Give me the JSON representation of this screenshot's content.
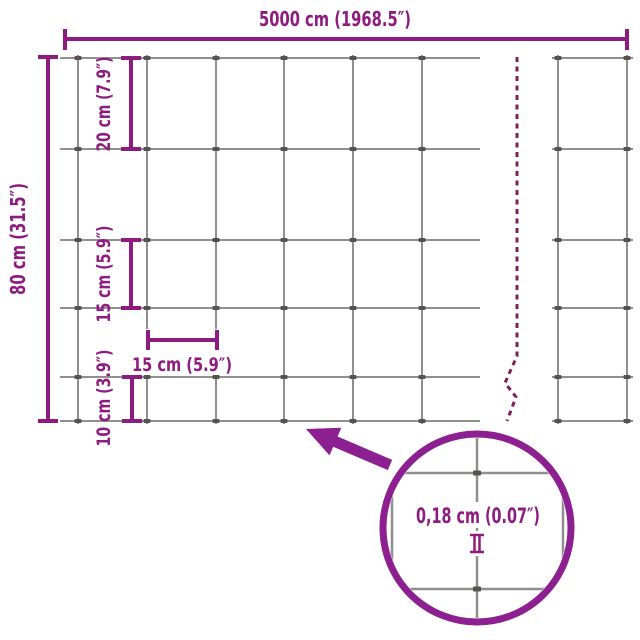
{
  "diagram": {
    "type": "fence-mesh-dimension-diagram",
    "colors": {
      "accent": "#8E1C80",
      "detail_accent": "#8D2090",
      "wire": "#8F8F8F",
      "clip": "#56524C",
      "break_line": "#7E2056",
      "background": "#FFFFFF"
    },
    "dimensions": {
      "total_width_label": "5000 cm (1968.5″)",
      "total_height_label": "80 cm (31.5″)",
      "row_gap_top_label": "20 cm (7.9″)",
      "row_gap_middle_label": "15 cm (5.9″)",
      "row_gap_bottom_label": "10 cm (3.9″)",
      "column_gap_label": "15 cm (5.9″)",
      "wire_thickness_label": "0,18 cm (0.07″)"
    }
  }
}
